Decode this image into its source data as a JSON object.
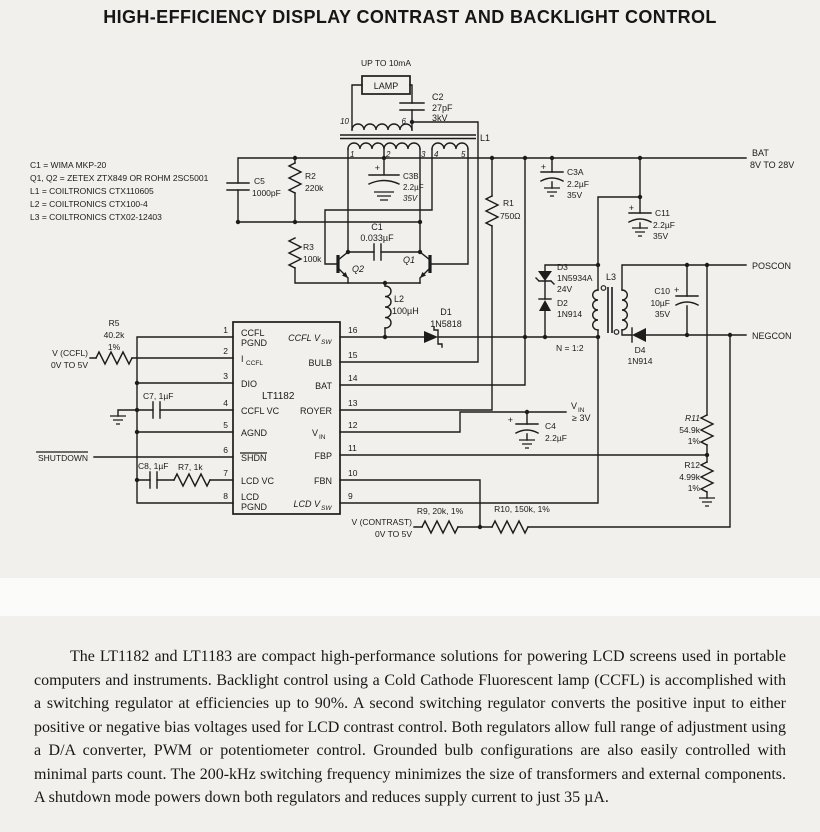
{
  "title": "HIGH-EFFICIENCY DISPLAY CONTRAST AND BACKLIGHT CONTROL",
  "notes": [
    "C1 = WIMA MKP-20",
    "Q1, Q2 = ZETEX ZTX849 OR ROHM 2SC5001",
    "L1 = COILTRONICS CTX110605",
    "L2 = COILTRONICS CTX100-4",
    "L3 = COILTRONICS CTX02-12403"
  ],
  "lamp": {
    "current": "UP TO 10mA",
    "label": "LAMP"
  },
  "symbols": {
    "plus": "+"
  },
  "ports": {
    "bat": {
      "label": "BAT",
      "range": "8V TO 28V"
    },
    "poscon": "POSCON",
    "negcon": "NEGCON",
    "vin": {
      "v": "V",
      "sub": "IN",
      "cond": "≥ 3V"
    },
    "vccfl": {
      "label": "V (CCFL)",
      "range": "0V TO 5V"
    },
    "vcontrast": {
      "label": "V (CONTRAST)",
      "range": "0V TO 5V"
    },
    "shutdown": "SHUTDOWN"
  },
  "components": {
    "c1": {
      "ref": "C1",
      "value": "0.033µF"
    },
    "c2": {
      "ref": "C2",
      "value": "27pF",
      "rating": "3kV"
    },
    "c3a": {
      "ref": "C3A",
      "value": "2.2µF",
      "rating": "35V"
    },
    "c3b": {
      "ref": "C3B",
      "value": "2.2µF",
      "rating": "35V"
    },
    "c4": {
      "ref": "C4",
      "value": "2.2µF"
    },
    "c5": {
      "ref": "C5",
      "value": "1000pF"
    },
    "c7": {
      "label": "C7, 1µF"
    },
    "c8": {
      "label": "C8, 1µF"
    },
    "c10": {
      "ref": "C10",
      "value": "10µF",
      "rating": "35V"
    },
    "c11": {
      "ref": "C11",
      "value": "2.2µF",
      "rating": "35V"
    },
    "r1": {
      "ref": "R1",
      "value": "750Ω"
    },
    "r2": {
      "ref": "R2",
      "value": "220k"
    },
    "r3": {
      "ref": "R3",
      "value": "100k"
    },
    "r5": {
      "ref": "R5",
      "value": "40.2k",
      "tol": "1%"
    },
    "r7": {
      "label": "R7, 1k"
    },
    "r9": {
      "label": "R9, 20k, 1%"
    },
    "r10": {
      "label": "R10, 150k, 1%"
    },
    "r11": {
      "ref": "R11",
      "value": "54.9k",
      "tol": "1%"
    },
    "r12": {
      "ref": "R12",
      "value": "4.99k",
      "tol": "1%"
    },
    "d1": {
      "ref": "D1",
      "part": "1N5818"
    },
    "d2": {
      "ref": "D2",
      "part": "1N914"
    },
    "d3": {
      "ref": "D3",
      "part": "1N5934A",
      "rating": "24V"
    },
    "d4": {
      "ref": "D4",
      "part": "1N914"
    },
    "q1": {
      "ref": "Q1"
    },
    "q2": {
      "ref": "Q2"
    },
    "l1": {
      "ref": "L1",
      "pins": {
        "p1": "1",
        "p2": "2",
        "p3": "3",
        "p4": "4",
        "p5": "5",
        "p10": "10",
        "p6": "6"
      }
    },
    "l2": {
      "ref": "L2",
      "value": "100µH"
    },
    "l3": {
      "ref": "L3",
      "ratio": "N = 1:2"
    }
  },
  "ic": {
    "name": "LT1182",
    "pins": {
      "p1": {
        "n": "1",
        "line1": "CCFL",
        "line2": "PGND"
      },
      "p2": {
        "n": "2",
        "main": "I",
        "sub": "CCFL"
      },
      "p3": {
        "n": "3",
        "label": "DIO"
      },
      "p4": {
        "n": "4",
        "label": "CCFL VC"
      },
      "p5": {
        "n": "5",
        "label": "AGND"
      },
      "p6": {
        "n": "6",
        "label": "SHDN"
      },
      "p7": {
        "n": "7",
        "label": "LCD VC"
      },
      "p8": {
        "n": "8",
        "line1": "LCD",
        "line2": "PGND"
      },
      "p9": {
        "n": "9",
        "main": "LCD V",
        "sub": "SW"
      },
      "p10": {
        "n": "10",
        "label": "FBN"
      },
      "p11": {
        "n": "11",
        "label": "FBP"
      },
      "p12": {
        "n": "12",
        "main": "V",
        "sub": "IN"
      },
      "p13": {
        "n": "13",
        "label": "ROYER"
      },
      "p14": {
        "n": "14",
        "label": "BAT"
      },
      "p15": {
        "n": "15",
        "label": "BULB"
      },
      "p16": {
        "n": "16",
        "main": "CCFL V",
        "sub": "SW"
      }
    }
  },
  "paragraph": "The LT1182 and LT1183 are compact high-performance solutions for powering LCD screens used in portable computers and instruments. Backlight control using a Cold Cathode Fluorescent lamp (CCFL) is accomplished with a switching regulator at efficiencies up to 90%. A second switching regulator converts the positive input to either positive or negative bias voltages used for LCD contrast control. Both regulators allow full range of adjustment using a D/A converter, PWM or potentiometer control. Grounded bulb configurations are also easily controlled with minimal parts count. The 200-kHz switching frequency minimizes the size of transformers and external components. A shutdown mode powers down both regulators and reduces supply current to just 35 µA."
}
